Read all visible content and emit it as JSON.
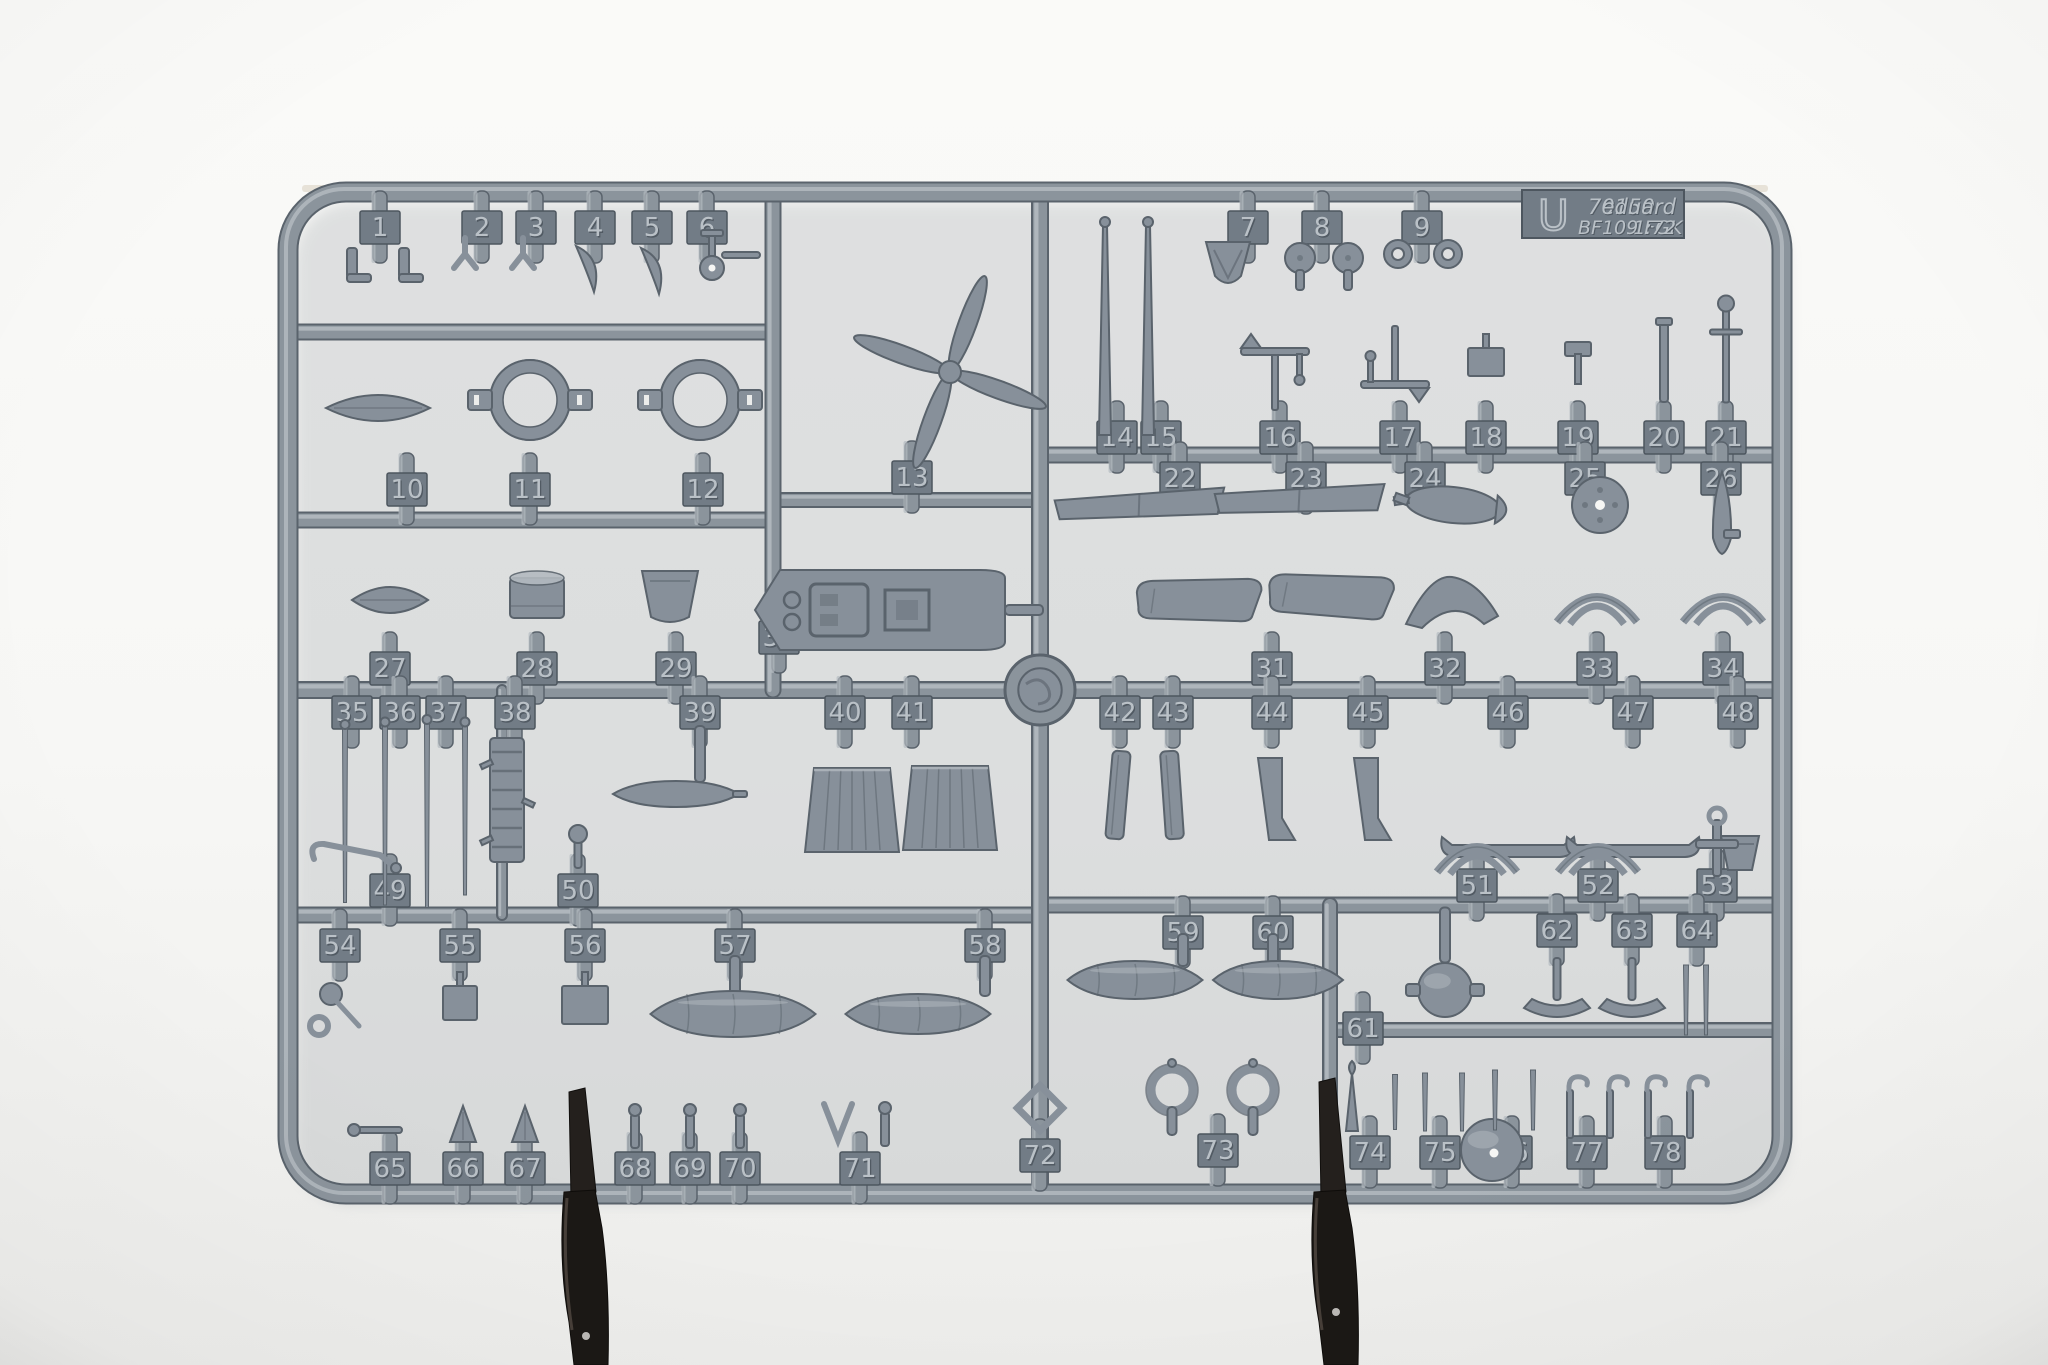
{
  "label": {
    "sprue_letter": "U",
    "kit_number": "70150",
    "brand": "eduard",
    "subject": "BF109 FGK",
    "scale": "1:72"
  },
  "colors": {
    "background_top": "#fafaf8",
    "background_bottom": "#eeeeec",
    "plastic_fill": "#87909a",
    "plastic_mid": "#8b949c",
    "plastic_dark": "#5a636c",
    "plastic_darker": "#4d565f",
    "plastic_light": "#b3bac0",
    "tag_face": "#727c86",
    "tag_text": "#bac1c7",
    "tag_text_shadow": "#515a63",
    "clip_fill": "#1b1815",
    "clip_edge": "#4d443d",
    "warm_edge": "#d9cfc0",
    "hole_white": "#f6f6f4"
  },
  "sprue": {
    "frame": {
      "x": 288,
      "y": 192,
      "width": 1494,
      "height": 1002,
      "radius": 58,
      "thickness": 17
    },
    "molding_point": {
      "x": 1040,
      "y": 690,
      "r": 35
    },
    "label_tab": {
      "x": 1522,
      "y": 190,
      "width": 162,
      "height": 48
    },
    "runners": [
      {
        "x1": 296,
        "y1": 332,
        "x2": 773,
        "y2": 332,
        "w": 13
      },
      {
        "x1": 296,
        "y1": 520,
        "x2": 773,
        "y2": 520,
        "w": 13
      },
      {
        "x1": 773,
        "y1": 500,
        "x2": 1040,
        "y2": 500,
        "w": 12
      },
      {
        "x1": 1040,
        "y1": 455,
        "x2": 1774,
        "y2": 455,
        "w": 13
      },
      {
        "x1": 296,
        "y1": 690,
        "x2": 1774,
        "y2": 690,
        "w": 14
      },
      {
        "x1": 296,
        "y1": 915,
        "x2": 1040,
        "y2": 915,
        "w": 13
      },
      {
        "x1": 1040,
        "y1": 905,
        "x2": 1774,
        "y2": 905,
        "w": 13
      },
      {
        "x1": 1330,
        "y1": 1030,
        "x2": 1774,
        "y2": 1030,
        "w": 12
      },
      {
        "x1": 773,
        "y1": 200,
        "x2": 773,
        "y2": 690,
        "w": 13
      },
      {
        "x1": 1040,
        "y1": 200,
        "x2": 1040,
        "y2": 1188,
        "w": 14
      },
      {
        "x1": 1330,
        "y1": 905,
        "x2": 1330,
        "y2": 1188,
        "w": 12
      },
      {
        "x1": 502,
        "y1": 690,
        "x2": 502,
        "y2": 915,
        "w": 8
      }
    ],
    "tags": [
      {
        "n": "1",
        "x": 380,
        "y": 227
      },
      {
        "n": "2",
        "x": 482,
        "y": 227
      },
      {
        "n": "3",
        "x": 536,
        "y": 227
      },
      {
        "n": "4",
        "x": 595,
        "y": 227
      },
      {
        "n": "5",
        "x": 652,
        "y": 227
      },
      {
        "n": "6",
        "x": 707,
        "y": 227
      },
      {
        "n": "7",
        "x": 1248,
        "y": 227
      },
      {
        "n": "8",
        "x": 1322,
        "y": 227
      },
      {
        "n": "9",
        "x": 1422,
        "y": 227
      },
      {
        "n": "10",
        "x": 407,
        "y": 489
      },
      {
        "n": "11",
        "x": 530,
        "y": 489
      },
      {
        "n": "12",
        "x": 703,
        "y": 489
      },
      {
        "n": "13",
        "x": 912,
        "y": 477
      },
      {
        "n": "14",
        "x": 1117,
        "y": 437
      },
      {
        "n": "15",
        "x": 1161,
        "y": 437
      },
      {
        "n": "16",
        "x": 1280,
        "y": 437
      },
      {
        "n": "17",
        "x": 1400,
        "y": 437
      },
      {
        "n": "18",
        "x": 1486,
        "y": 437
      },
      {
        "n": "19",
        "x": 1578,
        "y": 437
      },
      {
        "n": "20",
        "x": 1664,
        "y": 437
      },
      {
        "n": "21",
        "x": 1726,
        "y": 437
      },
      {
        "n": "22",
        "x": 1180,
        "y": 478
      },
      {
        "n": "23",
        "x": 1306,
        "y": 478
      },
      {
        "n": "24",
        "x": 1425,
        "y": 478
      },
      {
        "n": "25",
        "x": 1585,
        "y": 478
      },
      {
        "n": "26",
        "x": 1721,
        "y": 478
      },
      {
        "n": "27",
        "x": 390,
        "y": 668
      },
      {
        "n": "28",
        "x": 537,
        "y": 668
      },
      {
        "n": "29",
        "x": 676,
        "y": 668
      },
      {
        "n": "30",
        "x": 779,
        "y": 637
      },
      {
        "n": "31",
        "x": 1272,
        "y": 668
      },
      {
        "n": "32",
        "x": 1445,
        "y": 668
      },
      {
        "n": "33",
        "x": 1597,
        "y": 668
      },
      {
        "n": "34",
        "x": 1723,
        "y": 668
      },
      {
        "n": "35",
        "x": 352,
        "y": 712
      },
      {
        "n": "36",
        "x": 400,
        "y": 712
      },
      {
        "n": "37",
        "x": 446,
        "y": 712
      },
      {
        "n": "38",
        "x": 515,
        "y": 712
      },
      {
        "n": "39",
        "x": 700,
        "y": 712
      },
      {
        "n": "40",
        "x": 845,
        "y": 712
      },
      {
        "n": "41",
        "x": 912,
        "y": 712
      },
      {
        "n": "42",
        "x": 1120,
        "y": 712
      },
      {
        "n": "43",
        "x": 1173,
        "y": 712
      },
      {
        "n": "44",
        "x": 1272,
        "y": 712
      },
      {
        "n": "45",
        "x": 1368,
        "y": 712
      },
      {
        "n": "46",
        "x": 1508,
        "y": 712
      },
      {
        "n": "47",
        "x": 1633,
        "y": 712
      },
      {
        "n": "48",
        "x": 1738,
        "y": 712
      },
      {
        "n": "49",
        "x": 390,
        "y": 890
      },
      {
        "n": "50",
        "x": 578,
        "y": 890
      },
      {
        "n": "51",
        "x": 1477,
        "y": 885
      },
      {
        "n": "52",
        "x": 1598,
        "y": 885
      },
      {
        "n": "53",
        "x": 1717,
        "y": 885
      },
      {
        "n": "54",
        "x": 340,
        "y": 945
      },
      {
        "n": "55",
        "x": 460,
        "y": 945
      },
      {
        "n": "56",
        "x": 585,
        "y": 945
      },
      {
        "n": "57",
        "x": 735,
        "y": 945
      },
      {
        "n": "58",
        "x": 985,
        "y": 945
      },
      {
        "n": "59",
        "x": 1183,
        "y": 932
      },
      {
        "n": "60",
        "x": 1273,
        "y": 932
      },
      {
        "n": "61",
        "x": 1363,
        "y": 1028
      },
      {
        "n": "62",
        "x": 1557,
        "y": 930
      },
      {
        "n": "63",
        "x": 1632,
        "y": 930
      },
      {
        "n": "64",
        "x": 1697,
        "y": 930
      },
      {
        "n": "65",
        "x": 390,
        "y": 1168
      },
      {
        "n": "66",
        "x": 463,
        "y": 1168
      },
      {
        "n": "67",
        "x": 525,
        "y": 1168
      },
      {
        "n": "68",
        "x": 635,
        "y": 1168
      },
      {
        "n": "69",
        "x": 690,
        "y": 1168
      },
      {
        "n": "70",
        "x": 740,
        "y": 1168
      },
      {
        "n": "71",
        "x": 860,
        "y": 1168
      },
      {
        "n": "72",
        "x": 1040,
        "y": 1155
      },
      {
        "n": "73",
        "x": 1218,
        "y": 1150
      },
      {
        "n": "74",
        "x": 1370,
        "y": 1152
      },
      {
        "n": "75",
        "x": 1440,
        "y": 1152
      },
      {
        "n": "76",
        "x": 1512,
        "y": 1152
      },
      {
        "n": "77",
        "x": 1587,
        "y": 1152
      },
      {
        "n": "78",
        "x": 1665,
        "y": 1152
      }
    ],
    "parts": [
      {
        "n": "1",
        "shape": "bracket",
        "x": 352,
        "y": 268
      },
      {
        "n": "1",
        "shape": "bracket",
        "x": 404,
        "y": 268
      },
      {
        "n": "2",
        "shape": "fork",
        "x": 465,
        "y": 254
      },
      {
        "n": "3",
        "shape": "fork",
        "x": 523,
        "y": 254
      },
      {
        "n": "4",
        "shape": "cowl",
        "x": 585,
        "y": 268
      },
      {
        "n": "5",
        "shape": "cowl",
        "x": 650,
        "y": 270
      },
      {
        "n": "6",
        "shape": "tailwheel",
        "x": 712,
        "y": 262
      },
      {
        "n": "7",
        "shape": "scoop",
        "x": 1228,
        "y": 262
      },
      {
        "n": "8",
        "shape": "disc",
        "x": 1300,
        "y": 258,
        "w": 30
      },
      {
        "n": "8",
        "shape": "disc",
        "x": 1348,
        "y": 258,
        "w": 30
      },
      {
        "n": "9",
        "shape": "washer",
        "x": 1398,
        "y": 254,
        "w": 28
      },
      {
        "n": "9",
        "shape": "washer",
        "x": 1448,
        "y": 254,
        "w": 28
      },
      {
        "n": "10",
        "shape": "pod",
        "x": 378,
        "y": 408,
        "w": 104,
        "h": 26
      },
      {
        "n": "11",
        "shape": "ringframe",
        "x": 530,
        "y": 400
      },
      {
        "n": "12",
        "shape": "ringframe",
        "x": 700,
        "y": 400
      },
      {
        "n": "13",
        "shape": "propeller",
        "x": 950,
        "y": 372
      },
      {
        "n": "14",
        "shape": "mast",
        "x": 1105,
        "y": 330,
        "h": 210
      },
      {
        "n": "15",
        "shape": "mast",
        "x": 1148,
        "y": 330,
        "h": 210
      },
      {
        "n": "16",
        "shape": "lever",
        "x": 1275,
        "y": 368
      },
      {
        "n": "17",
        "shape": "lever",
        "x": 1395,
        "y": 368,
        "rot": 180
      },
      {
        "n": "18",
        "shape": "plate",
        "x": 1486,
        "y": 362,
        "w": 36,
        "h": 28
      },
      {
        "n": "19",
        "shape": "bracket19",
        "x": 1578,
        "y": 364
      },
      {
        "n": "20",
        "shape": "post",
        "x": 1664,
        "y": 362,
        "h": 80
      },
      {
        "n": "21",
        "shape": "ballrod",
        "x": 1726,
        "y": 355,
        "h": 95
      },
      {
        "n": "22",
        "shape": "stab",
        "x": 1140,
        "y": 505,
        "w": 170,
        "h": 26,
        "rot": -3
      },
      {
        "n": "23",
        "shape": "stab",
        "x": 1300,
        "y": 500,
        "w": 170,
        "h": 26,
        "rot": -2
      },
      {
        "n": "24",
        "shape": "bomb",
        "x": 1453,
        "y": 505,
        "w": 115,
        "h": 36,
        "rot": 6
      },
      {
        "n": "25",
        "shape": "disc25",
        "x": 1600,
        "y": 505
      },
      {
        "n": "26",
        "shape": "dart",
        "x": 1722,
        "y": 520
      },
      {
        "n": "27",
        "shape": "pod",
        "x": 390,
        "y": 600,
        "w": 76,
        "h": 26
      },
      {
        "n": "28",
        "shape": "drum",
        "x": 537,
        "y": 598
      },
      {
        "n": "29",
        "shape": "seat",
        "x": 670,
        "y": 597
      },
      {
        "n": "30",
        "shape": "floor",
        "x": 880,
        "y": 610
      },
      {
        "n": "31",
        "shape": "wingpanel",
        "x": 1200,
        "y": 600,
        "rot": -6
      },
      {
        "n": "31",
        "shape": "wingpanel",
        "x": 1332,
        "y": 596,
        "rot": -3
      },
      {
        "n": "32",
        "shape": "gull",
        "x": 1452,
        "y": 602
      },
      {
        "n": "33",
        "shape": "bow",
        "x": 1597,
        "y": 600
      },
      {
        "n": "34",
        "shape": "bow",
        "x": 1723,
        "y": 600
      },
      {
        "n": "35",
        "shape": "rodthin",
        "x": 345,
        "y": 815,
        "h": 175
      },
      {
        "n": "36",
        "shape": "rodthin",
        "x": 385,
        "y": 815,
        "h": 180
      },
      {
        "n": "37",
        "shape": "rodthin",
        "x": 427,
        "y": 815,
        "h": 185
      },
      {
        "n": "37",
        "shape": "rodthin",
        "x": 465,
        "y": 810,
        "h": 170
      },
      {
        "n": "38",
        "shape": "ladder",
        "x": 507,
        "y": 800
      },
      {
        "n": "39",
        "shape": "stem",
        "x": 700,
        "y": 754,
        "h": 56
      },
      {
        "n": "39",
        "shape": "slimtank",
        "x": 676,
        "y": 794,
        "w": 126,
        "h": 26
      },
      {
        "n": "40",
        "shape": "flap",
        "x": 852,
        "y": 810
      },
      {
        "n": "41",
        "shape": "flap",
        "x": 950,
        "y": 808
      },
      {
        "n": "42",
        "shape": "blade",
        "x": 1118,
        "y": 795,
        "rot": 5
      },
      {
        "n": "43",
        "shape": "blade",
        "x": 1172,
        "y": 795,
        "rot": -4
      },
      {
        "n": "44",
        "shape": "support",
        "x": 1270,
        "y": 800
      },
      {
        "n": "45",
        "shape": "support",
        "x": 1366,
        "y": 800
      },
      {
        "n": "46",
        "shape": "skid",
        "x": 1508,
        "y": 846
      },
      {
        "n": "47",
        "shape": "skid",
        "x": 1633,
        "y": 846
      },
      {
        "n": "48",
        "shape": "cup",
        "x": 1740,
        "y": 852
      },
      {
        "n": "49",
        "shape": "stick",
        "x": 352,
        "y": 855
      },
      {
        "n": "50",
        "shape": "balljoint",
        "x": 578,
        "y": 858
      },
      {
        "n": "51",
        "shape": "bow",
        "x": 1477,
        "y": 850
      },
      {
        "n": "52",
        "shape": "bow",
        "x": 1598,
        "y": 850
      },
      {
        "n": "53",
        "shape": "cross",
        "x": 1717,
        "y": 848
      },
      {
        "n": "54",
        "shape": "cane",
        "x": 335,
        "y": 1002
      },
      {
        "n": "55",
        "shape": "plate",
        "x": 460,
        "y": 1003,
        "w": 34,
        "h": 34
      },
      {
        "n": "56",
        "shape": "plate",
        "x": 585,
        "y": 1005,
        "w": 46,
        "h": 38
      },
      {
        "n": "57",
        "shape": "stem",
        "x": 735,
        "y": 976,
        "h": 40
      },
      {
        "n": "57",
        "shape": "tank",
        "x": 733,
        "y": 1014,
        "w": 165,
        "h": 46
      },
      {
        "n": "58",
        "shape": "stem",
        "x": 985,
        "y": 976,
        "h": 40
      },
      {
        "n": "58",
        "shape": "tank",
        "x": 918,
        "y": 1014,
        "w": 145,
        "h": 40
      },
      {
        "n": "59",
        "shape": "stem",
        "x": 1183,
        "y": 950,
        "h": 32
      },
      {
        "n": "59",
        "shape": "tank",
        "x": 1135,
        "y": 980,
        "w": 135,
        "h": 38
      },
      {
        "n": "60",
        "shape": "stem",
        "x": 1273,
        "y": 950,
        "h": 32
      },
      {
        "n": "60",
        "shape": "tank",
        "x": 1278,
        "y": 980,
        "w": 130,
        "h": 38
      },
      {
        "n": "61",
        "shape": "stem",
        "x": 1445,
        "y": 935,
        "h": 55
      },
      {
        "n": "61",
        "shape": "ball",
        "x": 1445,
        "y": 990,
        "w": 54,
        "variant": "lugs"
      },
      {
        "n": "61",
        "shape": "ball",
        "x": 1492,
        "y": 1150,
        "w": 62,
        "variant": "dot"
      },
      {
        "n": "62",
        "shape": "anchor",
        "x": 1557,
        "y": 990
      },
      {
        "n": "63",
        "shape": "anchor",
        "x": 1632,
        "y": 990
      },
      {
        "n": "64",
        "shape": "prong",
        "x": 1686,
        "y": 1000,
        "h": 70
      },
      {
        "n": "64",
        "shape": "prong",
        "x": 1706,
        "y": 1000,
        "h": 70
      },
      {
        "n": "65",
        "shape": "hornrod",
        "x": 380,
        "y": 1130
      },
      {
        "n": "66",
        "shape": "fin",
        "x": 463,
        "y": 1124
      },
      {
        "n": "67",
        "shape": "fin",
        "x": 525,
        "y": 1124
      },
      {
        "n": "68",
        "shape": "pin",
        "x": 635,
        "y": 1128
      },
      {
        "n": "69",
        "shape": "pin",
        "x": 690,
        "y": 1128
      },
      {
        "n": "70",
        "shape": "pin",
        "x": 740,
        "y": 1128
      },
      {
        "n": "71",
        "shape": "vshape",
        "x": 838,
        "y": 1124
      },
      {
        "n": "71",
        "shape": "pin",
        "x": 885,
        "y": 1126
      },
      {
        "n": "72",
        "shape": "diamond",
        "x": 1040,
        "y": 1108
      },
      {
        "n": "73",
        "shape": "ring",
        "x": 1172,
        "y": 1090
      },
      {
        "n": "73",
        "shape": "ring",
        "x": 1253,
        "y": 1090
      },
      {
        "n": "74",
        "shape": "spike",
        "x": 1352,
        "y": 1105
      },
      {
        "n": "74",
        "shape": "prong",
        "x": 1395,
        "y": 1102,
        "h": 55
      },
      {
        "n": "75",
        "shape": "prong",
        "x": 1425,
        "y": 1102,
        "h": 58
      },
      {
        "n": "75",
        "shape": "prong",
        "x": 1462,
        "y": 1102,
        "h": 58
      },
      {
        "n": "76",
        "shape": "prong",
        "x": 1495,
        "y": 1100,
        "h": 60
      },
      {
        "n": "76",
        "shape": "prong",
        "x": 1533,
        "y": 1100,
        "h": 60
      },
      {
        "n": "77",
        "shape": "hook",
        "x": 1570,
        "y": 1108
      },
      {
        "n": "77",
        "shape": "hook",
        "x": 1610,
        "y": 1108
      },
      {
        "n": "78",
        "shape": "hook",
        "x": 1648,
        "y": 1108
      },
      {
        "n": "78",
        "shape": "hook",
        "x": 1690,
        "y": 1108
      }
    ],
    "clips": [
      {
        "cx": 578,
        "tip_y": 1092,
        "dot_y": 1336
      },
      {
        "cx": 1328,
        "tip_y": 1082,
        "dot_y": 1312
      }
    ]
  }
}
